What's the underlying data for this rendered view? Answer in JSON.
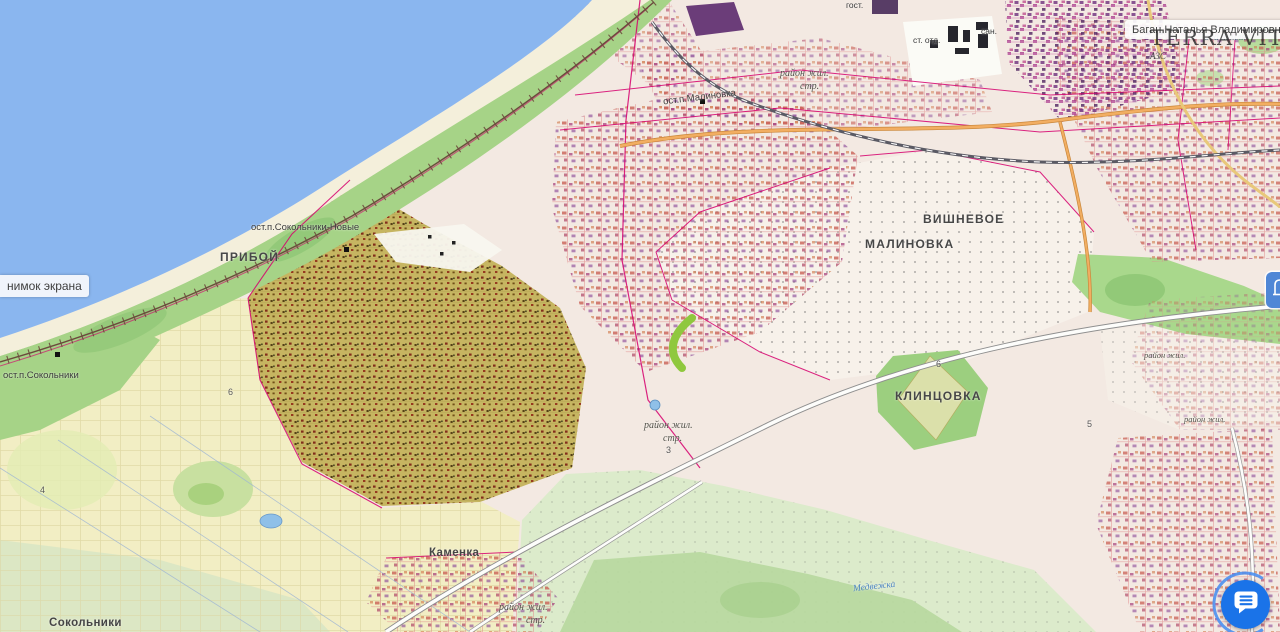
{
  "watermark": {
    "text": "TERRA VITA"
  },
  "tooltips": {
    "screenshot": {
      "text": "нимок экрана"
    },
    "owner": {
      "text": "Баган Наталья Владимировна"
    }
  },
  "map": {
    "labels": [
      {
        "text": "ПРИБОЙ"
      },
      {
        "text": "МАЛИНОВКА"
      },
      {
        "text": "ВИШНЕВОЕ"
      },
      {
        "text": "КЛИНЦОВКА"
      },
      {
        "text": "Каменка"
      },
      {
        "text": "Сокольники"
      },
      {
        "text": "ост.п.Сокольники"
      },
      {
        "text": "ост.п.Сокольники-Новые"
      },
      {
        "text": "ост.п.Малиновка"
      },
      {
        "text": "район жил."
      },
      {
        "text": "стр."
      },
      {
        "text": "район жил."
      },
      {
        "text": "стр."
      },
      {
        "text": "3"
      },
      {
        "text": "район жил."
      },
      {
        "text": "район жил."
      },
      {
        "text": "район жил."
      },
      {
        "text": "стр."
      },
      {
        "text": "гост."
      },
      {
        "text": "сан."
      },
      {
        "text": "ст. отд."
      },
      {
        "text": "АЗС"
      },
      {
        "text": "ова земля"
      },
      {
        "text": "Медвежка"
      },
      {
        "text": "4"
      },
      {
        "text": "6"
      },
      {
        "text": "6"
      },
      {
        "text": "5"
      }
    ]
  },
  "fab": {
    "icon": "chat-bubble-icon",
    "color": "#1a73e8"
  },
  "poi": {
    "icon": "building-icon",
    "color": "#4f87d6"
  },
  "colors": {
    "water": "#8ab6ef",
    "sand": "#f4efdb",
    "coast_green": "#a6d387",
    "land_pink": "#f3e9e2",
    "parcel_yellow": "#f2eec4",
    "garden_olive": "#c6b561",
    "meadow_green": "#dcebcb",
    "park_green": "#9ccf7f",
    "cadastral_magenta": "#d6006e",
    "highlight_mark_green": "#8fc83e"
  }
}
